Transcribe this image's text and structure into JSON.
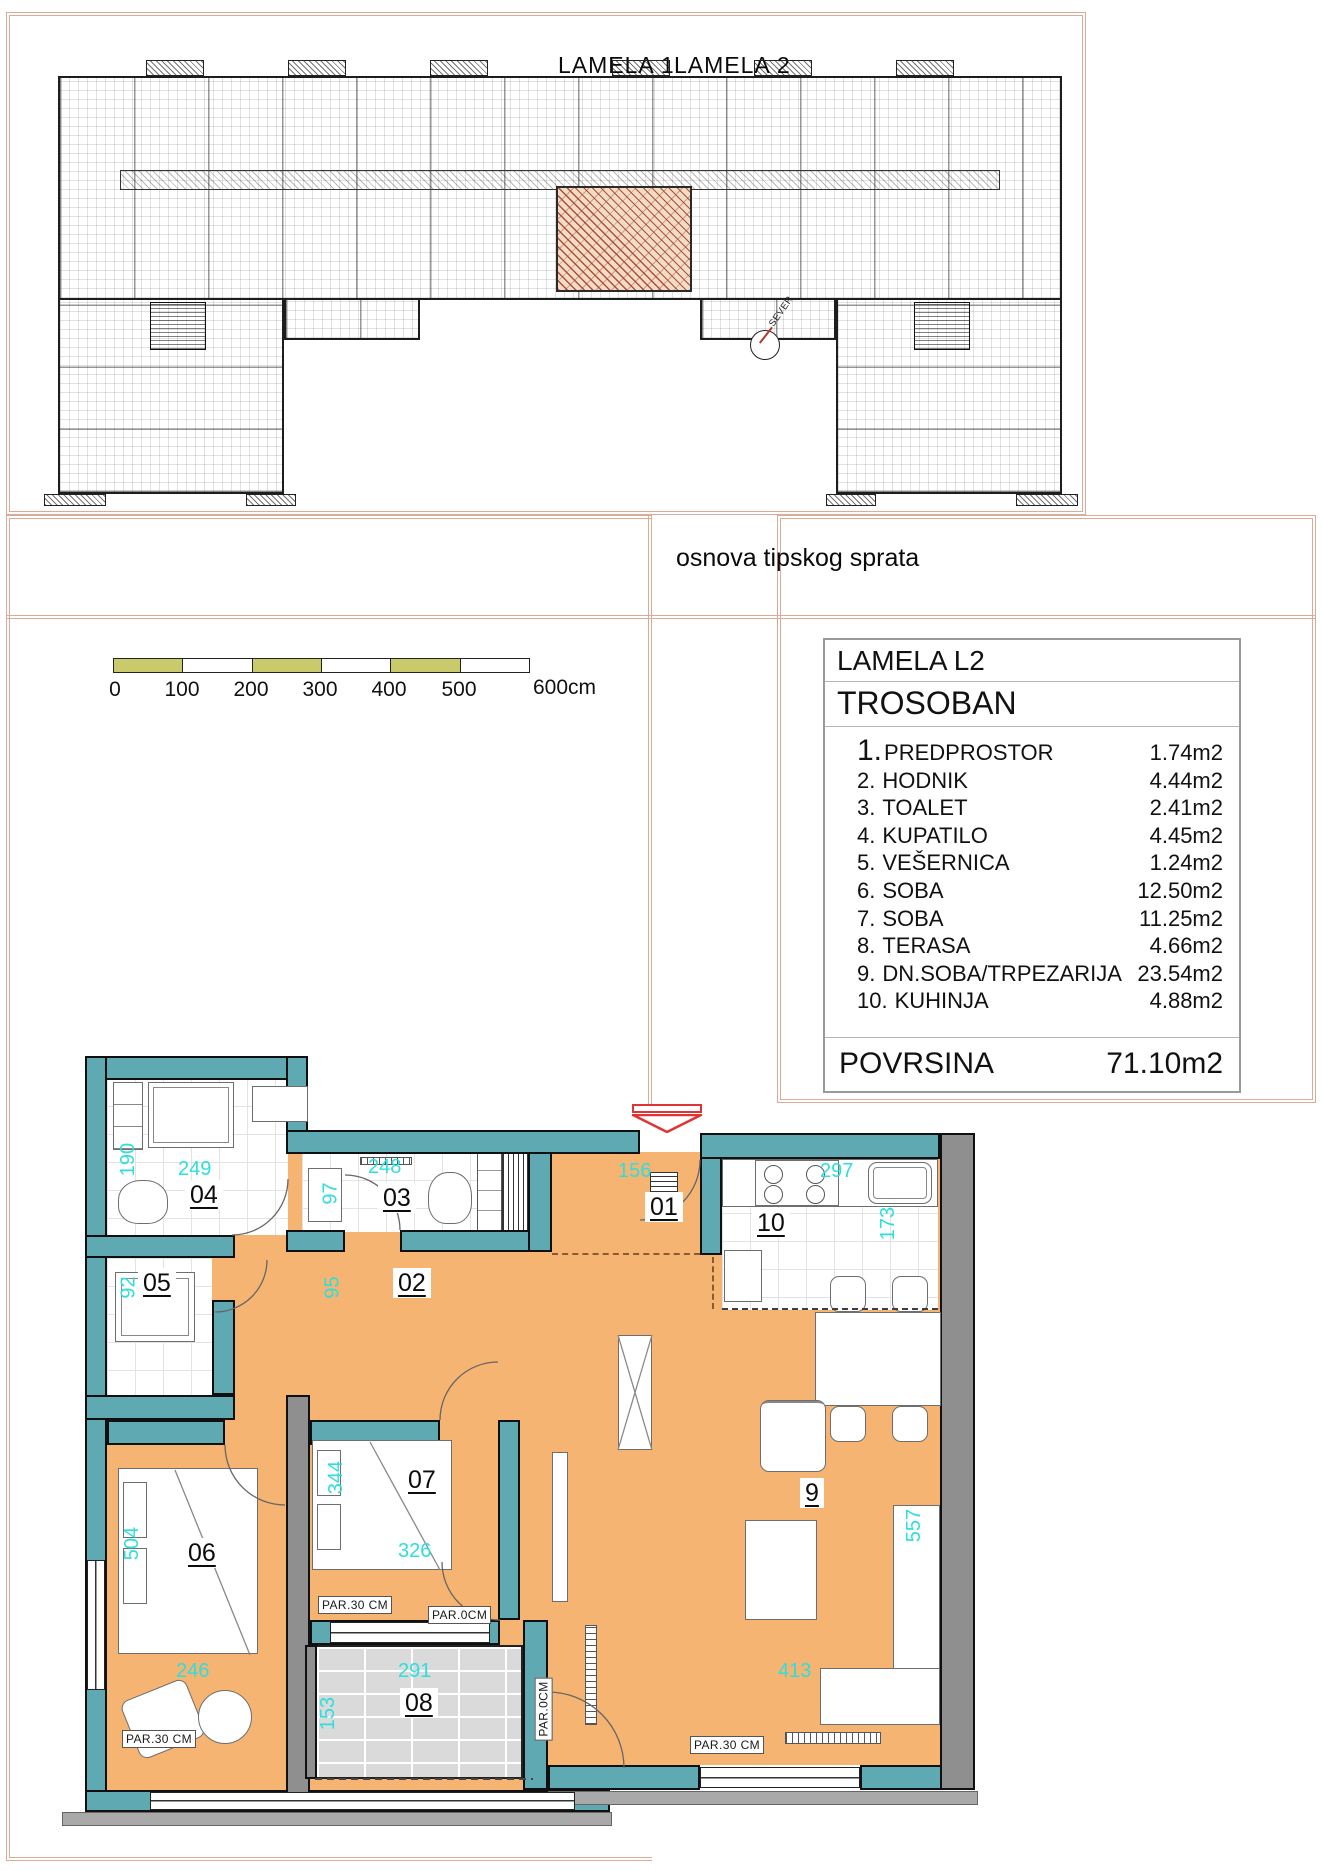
{
  "building": {
    "lamela1_label": "LAMELA 1",
    "lamela2_label": "LAMELA 2",
    "caption": "osnova tipskog sprata",
    "north_label": "SEVER"
  },
  "scalebar": {
    "ticks": [
      "0",
      "100",
      "200",
      "300",
      "400",
      "500"
    ],
    "end": "600cm"
  },
  "info_table": {
    "title": "LAMELA L2",
    "subtitle": "TROSOBAN",
    "rows": [
      {
        "num": "1.",
        "name": "PREDPROSTOR",
        "area": "1.74m2"
      },
      {
        "num": "2.",
        "name": "HODNIK",
        "area": "4.44m2"
      },
      {
        "num": "3.",
        "name": "TOALET",
        "area": "2.41m2"
      },
      {
        "num": "4.",
        "name": "KUPATILO",
        "area": "4.45m2"
      },
      {
        "num": "5.",
        "name": "VEŠERNICA",
        "area": "1.24m2"
      },
      {
        "num": "6.",
        "name": "SOBA",
        "area": "12.50m2"
      },
      {
        "num": "7.",
        "name": "SOBA",
        "area": "11.25m2"
      },
      {
        "num": "8.",
        "name": "TERASA",
        "area": "4.66m2"
      },
      {
        "num": "9.",
        "name": "DN.SOBA/TRPEZARIJA",
        "area": "23.54m2"
      },
      {
        "num": "10.",
        "name": "KUHINJA",
        "area": "4.88m2"
      }
    ],
    "total_label": "POVRSINA",
    "total_value": "71.10m2"
  },
  "plan": {
    "labels": {
      "r01": "01",
      "r02": "02",
      "r03": "03",
      "r04": "04",
      "r05": "05",
      "r06": "06",
      "r07": "07",
      "r08": "08",
      "r09": "9",
      "r10": "10"
    },
    "dims": {
      "d190": "190",
      "d249": "249",
      "d97": "97",
      "d248": "248",
      "d156": "156",
      "d297": "297",
      "d173": "173",
      "d92": "92",
      "d95": "95",
      "d344": "344",
      "d326": "326",
      "d504": "504",
      "d246": "246",
      "d291": "291",
      "d153": "153",
      "d413": "413",
      "d557": "557"
    },
    "annotations": {
      "par30": "PAR.30 CM",
      "par0": "PAR.0CM"
    },
    "colors": {
      "wall": "#5fa9b2",
      "floor": "#f6b472",
      "gray_wall": "#8f8f8f",
      "dimension_text": "#2ddedd",
      "entrance_arrow": "#e23333",
      "frame": "#dcab97",
      "scale_olive": "#c9ca6b"
    }
  }
}
